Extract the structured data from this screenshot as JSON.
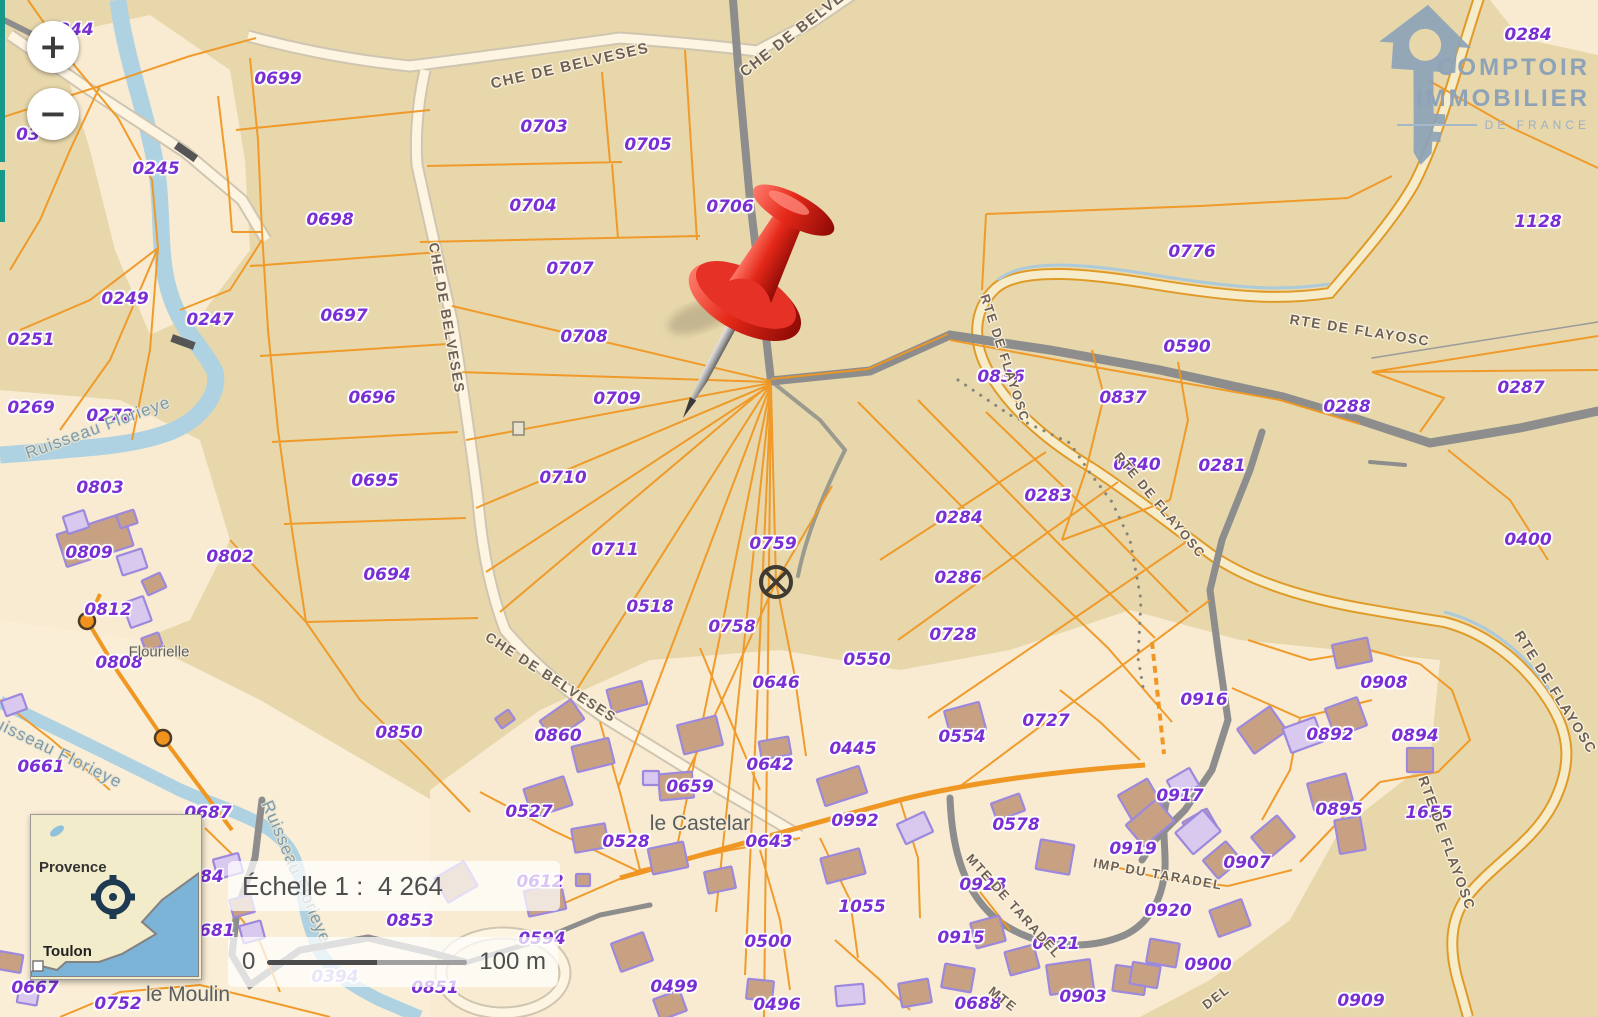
{
  "zoom_controls": {
    "zoom_in": "+",
    "zoom_out": "−"
  },
  "logo": {
    "icon": "house-key-icon",
    "line1": "COMPTOIR",
    "line2": "IMMOBILIER",
    "line3": "DE FRANCE"
  },
  "scale": {
    "label": "Échelle 1 :  4 264",
    "bar_start": "0",
    "bar_end": "100 m"
  },
  "minimap": {
    "region_label": "Provence",
    "city_label": "Toulon",
    "icon": "crosshair-icon"
  },
  "marker": {
    "name": "red-pushpin",
    "color": "#d81f14"
  },
  "colors": {
    "map_tan": "#e7d7ab",
    "land_cream": "#f8ebd1",
    "parcel_line": "#ef9722",
    "parcel_label": "#7a2fd4",
    "road_gray": "#8d8d8d",
    "river": "#aed2e2",
    "building_fill": "#c8a183",
    "building_stroke": "#9c88dd",
    "logo_blue": "#8ea3b8",
    "teal_strip": "#16998a",
    "minimap_sea": "#7cb4d7"
  },
  "map": {
    "place_labels": [
      {
        "t": "Flourielle",
        "x": 159,
        "y": 652,
        "s": 15
      },
      {
        "t": "le Castelar",
        "x": 700,
        "y": 824,
        "s": 21
      },
      {
        "t": "le Moulin",
        "x": 188,
        "y": 995,
        "s": 21
      }
    ],
    "road_labels": [
      {
        "t": "CHE DE BELVESES",
        "x": 570,
        "y": 66,
        "r": -13,
        "s": 15
      },
      {
        "t": "CHE DE BELVESES",
        "x": 806,
        "y": 24,
        "r": -38,
        "s": 15
      },
      {
        "t": "CHE DE BELVESES",
        "x": 447,
        "y": 318,
        "r": 80,
        "s": 14
      },
      {
        "t": "CHE DE BELVESES",
        "x": 551,
        "y": 677,
        "r": 33,
        "s": 14
      },
      {
        "t": "RTE DE FLAYOSC",
        "x": 1005,
        "y": 358,
        "r": 72,
        "s": 13
      },
      {
        "t": "RTE DE FLAYOSC",
        "x": 1360,
        "y": 330,
        "r": 9,
        "s": 14
      },
      {
        "t": "RTE DE FLAYOSC",
        "x": 1160,
        "y": 505,
        "r": 50,
        "s": 13
      },
      {
        "t": "RTE DE FLAYOSC",
        "x": 1556,
        "y": 692,
        "r": 58,
        "s": 14
      },
      {
        "t": "RTE DE FLAYOSC",
        "x": 1447,
        "y": 843,
        "r": 70,
        "s": 14
      },
      {
        "t": "IMP DU TARADEL",
        "x": 1158,
        "y": 874,
        "r": 10,
        "s": 13
      },
      {
        "t": "MTE DE TARADEL",
        "x": 1014,
        "y": 906,
        "r": 48,
        "s": 13
      },
      {
        "t": "MTE",
        "x": 1003,
        "y": 999,
        "r": 38,
        "s": 13
      },
      {
        "t": "DEL",
        "x": 1216,
        "y": 997,
        "r": -38,
        "s": 13
      }
    ],
    "river_labels": [
      {
        "t": "Ruisseau Florieye",
        "x": 98,
        "y": 428,
        "r": -20
      },
      {
        "t": "Ruisseau Florieye",
        "x": 296,
        "y": 872,
        "r": 67
      },
      {
        "t": "Ruisseau Florieye",
        "x": 52,
        "y": 750,
        "r": 26
      }
    ],
    "parcel_labels": [
      {
        "t": "0244",
        "x": 70,
        "y": 30
      },
      {
        "t": "03",
        "x": 28,
        "y": 135
      },
      {
        "t": "0699",
        "x": 278,
        "y": 79
      },
      {
        "t": "0703",
        "x": 544,
        "y": 127
      },
      {
        "t": "0705",
        "x": 648,
        "y": 145
      },
      {
        "t": "0704",
        "x": 533,
        "y": 206
      },
      {
        "t": "0706",
        "x": 730,
        "y": 207
      },
      {
        "t": "0698",
        "x": 330,
        "y": 220
      },
      {
        "t": "0245",
        "x": 156,
        "y": 169
      },
      {
        "t": "0707",
        "x": 570,
        "y": 269
      },
      {
        "t": "0249",
        "x": 125,
        "y": 299
      },
      {
        "t": "0247",
        "x": 210,
        "y": 320
      },
      {
        "t": "0251",
        "x": 31,
        "y": 340
      },
      {
        "t": "0697",
        "x": 344,
        "y": 316
      },
      {
        "t": "0708",
        "x": 584,
        "y": 337
      },
      {
        "t": "0696",
        "x": 372,
        "y": 398
      },
      {
        "t": "0709",
        "x": 617,
        "y": 399
      },
      {
        "t": "0269",
        "x": 31,
        "y": 408
      },
      {
        "t": "0272",
        "x": 110,
        "y": 416
      },
      {
        "t": "0803",
        "x": 100,
        "y": 488
      },
      {
        "t": "0710",
        "x": 563,
        "y": 478
      },
      {
        "t": "0695",
        "x": 375,
        "y": 481
      },
      {
        "t": "0809",
        "x": 89,
        "y": 553
      },
      {
        "t": "0802",
        "x": 230,
        "y": 557
      },
      {
        "t": "0711",
        "x": 615,
        "y": 550
      },
      {
        "t": "0759",
        "x": 773,
        "y": 544
      },
      {
        "t": "0694",
        "x": 387,
        "y": 575
      },
      {
        "t": "0812",
        "x": 108,
        "y": 610
      },
      {
        "t": "0518",
        "x": 650,
        "y": 607
      },
      {
        "t": "0808",
        "x": 119,
        "y": 663
      },
      {
        "t": "0758",
        "x": 732,
        "y": 627
      },
      {
        "t": "0550",
        "x": 867,
        "y": 660
      },
      {
        "t": "0646",
        "x": 776,
        "y": 683
      },
      {
        "t": "0661",
        "x": 41,
        "y": 767
      },
      {
        "t": "0850",
        "x": 399,
        "y": 733
      },
      {
        "t": "0860",
        "x": 558,
        "y": 736
      },
      {
        "t": "0727",
        "x": 1046,
        "y": 721
      },
      {
        "t": "0554",
        "x": 962,
        "y": 737
      },
      {
        "t": "0445",
        "x": 853,
        "y": 749
      },
      {
        "t": "0642",
        "x": 770,
        "y": 765
      },
      {
        "t": "0659",
        "x": 690,
        "y": 787
      },
      {
        "t": "0992",
        "x": 855,
        "y": 821
      },
      {
        "t": "0527",
        "x": 529,
        "y": 812
      },
      {
        "t": "0528",
        "x": 626,
        "y": 842
      },
      {
        "t": "0643",
        "x": 769,
        "y": 842
      },
      {
        "t": "0578",
        "x": 1016,
        "y": 825
      },
      {
        "t": "0612",
        "x": 540,
        "y": 882
      },
      {
        "t": "1055",
        "x": 862,
        "y": 907
      },
      {
        "t": "0923",
        "x": 983,
        "y": 885
      },
      {
        "t": "0853",
        "x": 410,
        "y": 921
      },
      {
        "t": "0915",
        "x": 961,
        "y": 938
      },
      {
        "t": "0920",
        "x": 1168,
        "y": 911
      },
      {
        "t": "0919",
        "x": 1133,
        "y": 849
      },
      {
        "t": "0917",
        "x": 1180,
        "y": 796
      },
      {
        "t": "0916",
        "x": 1204,
        "y": 700
      },
      {
        "t": "0908",
        "x": 1384,
        "y": 683
      },
      {
        "t": "0892",
        "x": 1330,
        "y": 735
      },
      {
        "t": "0894",
        "x": 1415,
        "y": 736
      },
      {
        "t": "0895",
        "x": 1339,
        "y": 810
      },
      {
        "t": "1655",
        "x": 1429,
        "y": 813
      },
      {
        "t": "0907",
        "x": 1247,
        "y": 863
      },
      {
        "t": "0921",
        "x": 1056,
        "y": 944
      },
      {
        "t": "0900",
        "x": 1208,
        "y": 965
      },
      {
        "t": "0903",
        "x": 1083,
        "y": 997
      },
      {
        "t": "0688",
        "x": 978,
        "y": 1004
      },
      {
        "t": "0909",
        "x": 1361,
        "y": 1001
      },
      {
        "t": "0496",
        "x": 777,
        "y": 1005
      },
      {
        "t": "0499",
        "x": 674,
        "y": 987
      },
      {
        "t": "0500",
        "x": 768,
        "y": 942
      },
      {
        "t": "0594",
        "x": 542,
        "y": 939
      },
      {
        "t": "0851",
        "x": 435,
        "y": 988
      },
      {
        "t": "0394",
        "x": 335,
        "y": 977,
        "f": 1
      },
      {
        "t": "0681",
        "x": 211,
        "y": 931
      },
      {
        "t": "0684",
        "x": 200,
        "y": 877
      },
      {
        "t": "0687",
        "x": 208,
        "y": 813
      },
      {
        "t": "0667",
        "x": 35,
        "y": 988
      },
      {
        "t": "0752",
        "x": 118,
        "y": 1004
      },
      {
        "t": "0284",
        "x": 1528,
        "y": 35
      },
      {
        "t": "1128",
        "x": 1538,
        "y": 222
      },
      {
        "t": "0776",
        "x": 1192,
        "y": 252
      },
      {
        "t": "0590",
        "x": 1187,
        "y": 347
      },
      {
        "t": "0836",
        "x": 1001,
        "y": 377
      },
      {
        "t": "0837",
        "x": 1123,
        "y": 398
      },
      {
        "t": "0287",
        "x": 1521,
        "y": 388
      },
      {
        "t": "0288",
        "x": 1347,
        "y": 407
      },
      {
        "t": "0840",
        "x": 1137,
        "y": 465
      },
      {
        "t": "0281",
        "x": 1222,
        "y": 466
      },
      {
        "t": "0283",
        "x": 1048,
        "y": 496
      },
      {
        "t": "0284",
        "x": 959,
        "y": 518
      },
      {
        "t": "0400",
        "x": 1528,
        "y": 540
      },
      {
        "t": "0286",
        "x": 958,
        "y": 578
      },
      {
        "t": "0728",
        "x": 953,
        "y": 635
      }
    ]
  }
}
